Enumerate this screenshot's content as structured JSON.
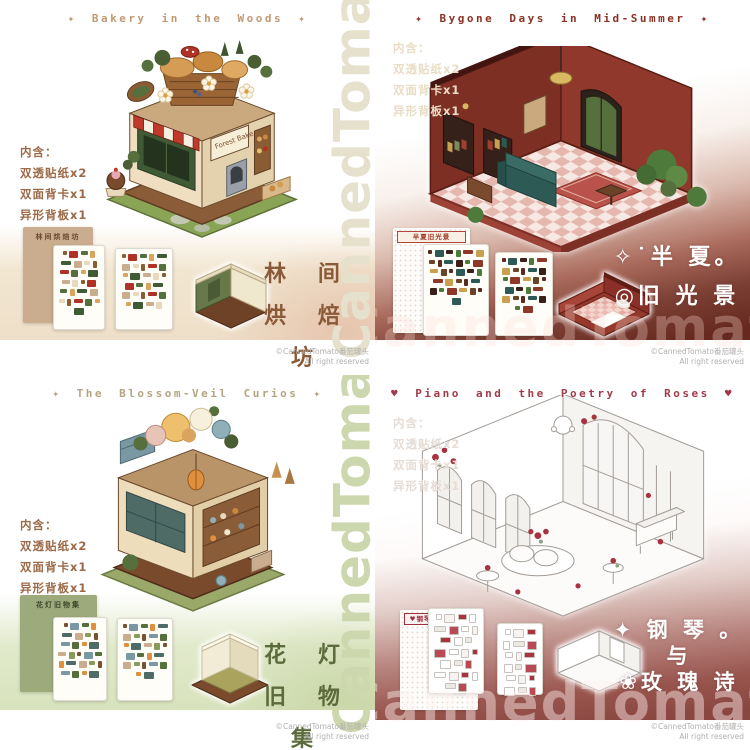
{
  "page": {
    "watermark_text": "CannedTomato",
    "copyright_line1": "©CannedTomato番茄罐头",
    "copyright_line2": "All right reserved"
  },
  "contents": {
    "heading": "内含：",
    "items": [
      "双透贴纸x2",
      "双面背卡x1",
      "异形背板x1"
    ]
  },
  "panels": [
    {
      "name": "bakery-in-the-woods",
      "title": "✦ Bakery in the Woods ✦",
      "cn_lines": [
        "林 间",
        "烘 焙 坊"
      ],
      "card_title": "林间烘焙坊",
      "sign_text": "Forest Bake",
      "sheet_palette": [
        "#8a5c33",
        "#b03226",
        "#55703c",
        "#d9a45e",
        "#3f5a35",
        "#c9ad8e",
        "#e8d9bd"
      ],
      "theme": {
        "title": "#c09a74",
        "contents": "#9c6a48",
        "cn": "#8a5a38",
        "watermark": "#e6e1cd"
      }
    },
    {
      "name": "bygone-days-in-mid-summer",
      "title": "✦ Bygone Days in Mid-Summer ✦",
      "cn_lines": [
        "✧˙半 夏。",
        "◎旧 光 景"
      ],
      "card_title": "半夏旧光景",
      "sheet_palette": [
        "#5a2a20",
        "#2e5a55",
        "#3a2018",
        "#4e7a3c",
        "#8f382a",
        "#c8a050",
        "#6b4428"
      ],
      "theme": {
        "title": "#8a3224",
        "contents": "#e9ddc6",
        "cn": "#ffffff",
        "watermark": "rgba(255,222,212,0.30)"
      }
    },
    {
      "name": "the-blossom-veil-curios",
      "title": "✦ The Blossom-Veil Curios ✦",
      "cn_lines": [
        "花 灯",
        "旧 物 集"
      ],
      "card_title": "花灯旧物集",
      "sheet_palette": [
        "#7a5232",
        "#7a98a4",
        "#55703c",
        "#e0903c",
        "#4e6b66",
        "#c9ad8e",
        "#8a9a5a"
      ],
      "theme": {
        "title": "#b3a584",
        "contents": "#9c6a48",
        "cn": "#5c6b3c",
        "watermark": "#cdd7ae"
      }
    },
    {
      "name": "piano-and-the-poetry-of-roses",
      "title": "♥ Piano and the Poetry of Roses ♥",
      "cn_lines": [
        "✦ 钢 琴 。",
        "与",
        "❀玫 瑰 诗"
      ],
      "card_title": "♥钢琴与玫瑰诗♥",
      "sheet_palette": [
        "#ffffff",
        "#f6f3f0",
        "#a83240",
        "#ffffff",
        "#ece8e4",
        "#b84a56"
      ],
      "theme": {
        "title": "#a23a4a",
        "contents": "#e6dcd6",
        "cn": "#ffffff",
        "watermark": "rgba(255,242,240,0.45)"
      }
    }
  ]
}
